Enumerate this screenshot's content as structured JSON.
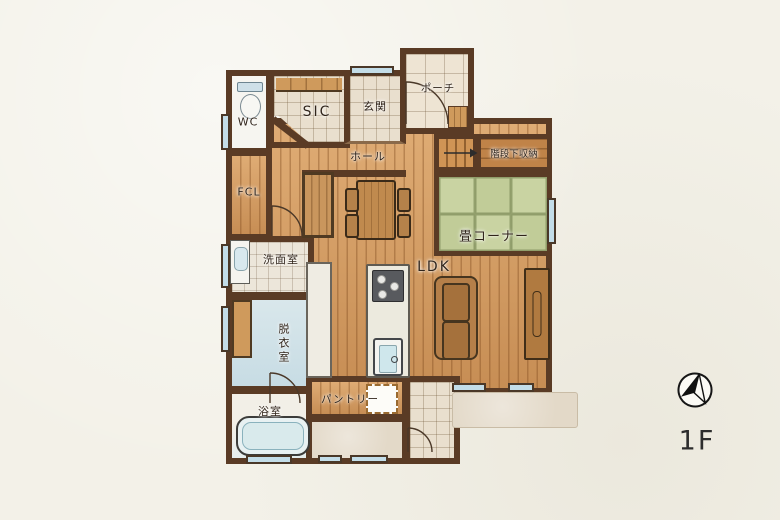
{
  "floor_plan": {
    "floor_label": "1F",
    "rooms": {
      "wc": "WC",
      "sic": "SIC",
      "genkan": "玄関",
      "porch": "ポーチ",
      "hall": "ホール",
      "stair_storage": "階段下収納",
      "tatami_corner": "畳コーナー",
      "fcl": "FCL",
      "washroom": "洗面室",
      "ldk": "LDK",
      "dressing_room": "脱衣室",
      "bathroom": "浴室",
      "pantry": "パントリー"
    },
    "icons": {
      "compass": "north-compass-icon"
    },
    "colors": {
      "paper": "#f3f1e8",
      "wall": "#5a3b25",
      "wood_floor": "#d49a5f",
      "tatami_green": "#c9d3a2",
      "tile": "#e9dfce",
      "water_blue": "#cfe2e8",
      "window_blue": "#c3dde8",
      "terrace_beige": "#e3d9c8"
    }
  }
}
